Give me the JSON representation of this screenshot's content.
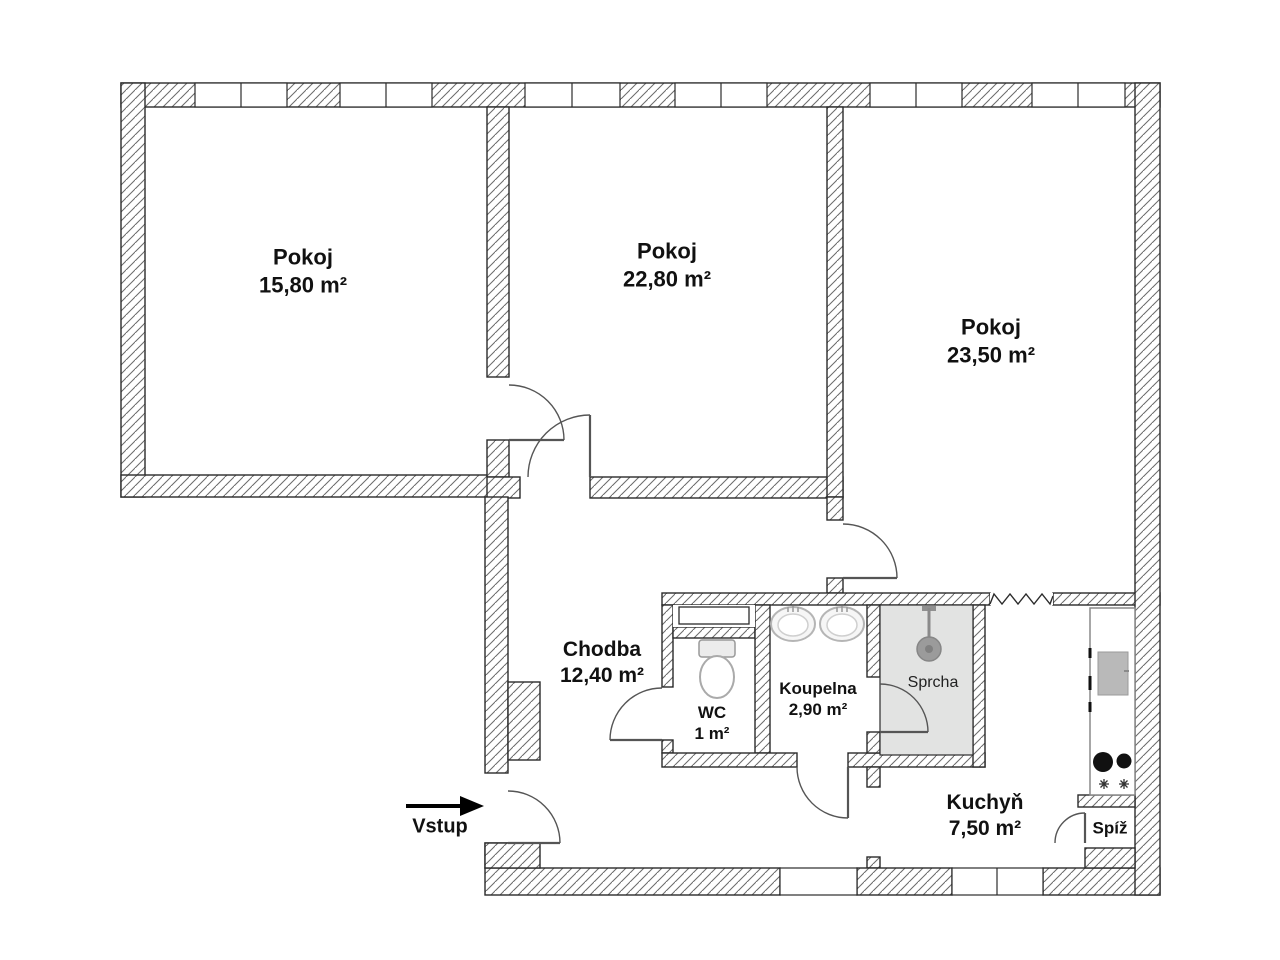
{
  "plan": {
    "title": "Apartment floor plan",
    "rooms": [
      {
        "name": "Pokoj",
        "area": "15,80 m²"
      },
      {
        "name": "Pokoj",
        "area": "22,80 m²"
      },
      {
        "name": "Pokoj",
        "area": "23,50 m²"
      },
      {
        "name": "Chodba",
        "area": "12,40 m²"
      },
      {
        "name": "WC",
        "area": "1 m²"
      },
      {
        "name": "Koupelna",
        "area": "2,90 m²"
      },
      {
        "name": "Sprcha"
      },
      {
        "name": "Kuchyň",
        "area": "7,50 m²"
      },
      {
        "name": "Spíž"
      }
    ],
    "entrance_label": "Vstup",
    "colors": {
      "wall_line": "#2b2b2b",
      "hatch_line": "#6a6a6a",
      "shower_fill": "#e2e3e2",
      "stove_fill": "#b9b9b9",
      "fixture_gray": "#9b9b9b"
    }
  }
}
